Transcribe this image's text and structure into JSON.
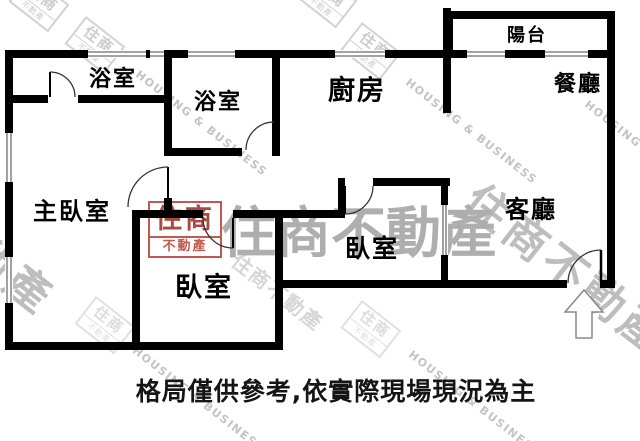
{
  "plan": {
    "rooms": {
      "bathroom_top": {
        "label": "浴室"
      },
      "bathroom_inner": {
        "label": "浴室"
      },
      "kitchen": {
        "label": "廚房"
      },
      "balcony": {
        "label": "陽台"
      },
      "dining_room": {
        "label": "餐廳"
      },
      "living_room": {
        "label": "客廳"
      },
      "master_bedroom": {
        "label": "主臥室"
      },
      "bedroom_left": {
        "label": "臥室"
      },
      "bedroom_right": {
        "label": "臥室"
      }
    },
    "disclaimer": "格局僅供參考,依實際現場現況為主",
    "colors": {
      "wall": "#000000",
      "watermark_gray": "#aeaeae",
      "watermark_red": "#c4574e"
    }
  },
  "watermark": {
    "brand_cjk": "住商不動產",
    "brand_en": "HOUSING & BUSINESS",
    "logo_top": "住商",
    "logo_bottom": "不動產"
  }
}
